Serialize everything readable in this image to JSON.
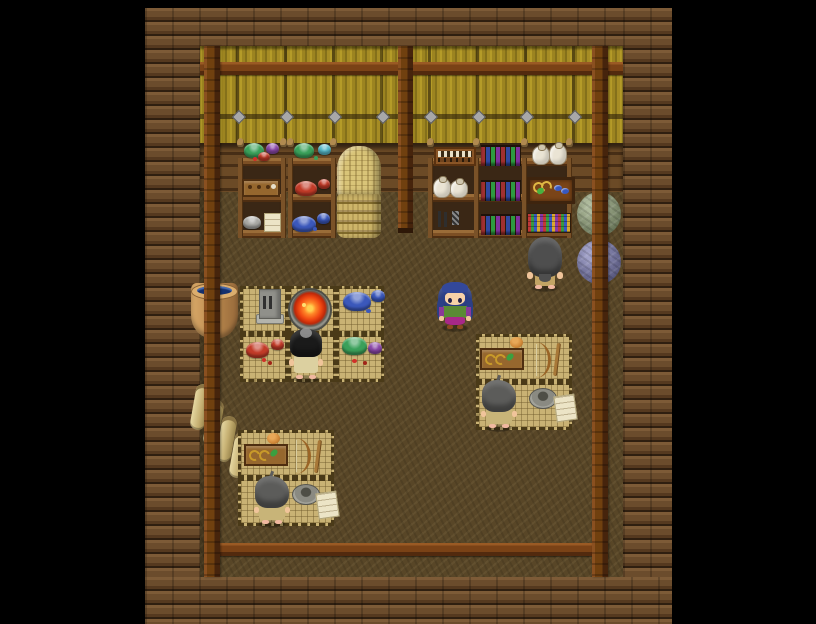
{
  "meta": {
    "type": "game-screenshot",
    "style": "RPG Maker top-down interior, pixel art",
    "scene": "weaving and dye workshop inside a log cabin",
    "resolution": {
      "width": 816,
      "height": 624
    },
    "visible_text": "none"
  },
  "palette": {
    "background": "#000000",
    "log_mid": "#6b4c2c",
    "bamboo_base": "#9c8420",
    "beam": "#7a4216",
    "stud": "#a8a8a8",
    "floor": "#584627",
    "mat": "#c9b274",
    "bowl_green": "#3aa05a",
    "bowl_cyan": "#56b8c8",
    "bowl_red": "#c23b28",
    "bowl_blue": "#3b58bb",
    "bowl_purple": "#8a48a8",
    "bowl_gray": "#a8a8a4",
    "fire_hot": "#ffd050",
    "fire_mid": "#ff8828",
    "fire_deep": "#c02808",
    "yarn_green_hi": "#aeba9c",
    "yarn_green": "#8a9678",
    "yarn_green_lo": "#5e6a4e",
    "yarn_blue_hi": "#a2a2c8",
    "yarn_blue": "#7878a0",
    "yarn_blue_lo": "#4e4e72",
    "dye_liquid": "#14306e",
    "hair_player": "#2c3f86",
    "hair_player_bangs": "#33489a",
    "hair_longgray": "#4e4e4e",
    "hair_black": "#1a1a1a",
    "hair_shaggy": "#5c5c5a",
    "outfit_player_top": "#5a8a34",
    "outfit_player_accent": "#8a3898",
    "outfit_player_skirt": "#a82888",
    "outfit_npc_tan": "#c2a464",
    "outfit_npc_robe": "#dcd0a0",
    "outfit_npc_work": "#c8b478"
  },
  "structure": {
    "walls": "horizontal log border on all four sides",
    "north_wall": "yellow bamboo screen with dark timber frame, horizontal beam and iron studs",
    "pillars": "three dark timber pillars (west, center, east)",
    "floor": "packed earth",
    "south_rail": "timber rail crossing the floor near the south wall"
  },
  "characters": [
    {
      "id": "player",
      "label": "player character",
      "hair": "long blue",
      "facing": "south",
      "outfit": "green top, purple sleeves, magenta skirt"
    },
    {
      "id": "npc_browser",
      "label": "long-haired villager browsing the east shelves",
      "hair": "waist-length dark gray",
      "facing": "north",
      "outfit": "tan"
    },
    {
      "id": "npc_crafter",
      "label": "villager tending the kiln",
      "hair": "black with gray patch",
      "facing": "north",
      "outfit": "pale robe"
    },
    {
      "id": "npc_spinner_east",
      "label": "villager at east work mat",
      "hair": "shaggy gray",
      "facing": "north",
      "outfit": "tan work clothes"
    },
    {
      "id": "npc_spinner_south",
      "label": "villager at south work mat",
      "hair": "shaggy gray",
      "facing": "north",
      "outfit": "tan work clothes"
    }
  ],
  "furniture": {
    "west_shelves": {
      "unit_a": {
        "top": "large green bowl, small violet bowl, small red bowl with red beads",
        "middle": "wooden stamp tray",
        "bottom": "gray bowl and folded paper"
      },
      "unit_b": {
        "top": "large green bowl, small teal bowl",
        "middle": "large and small red dye bowls",
        "bottom": "large and small blue dye bowls"
      }
    },
    "east_shelves": {
      "top_row": [
        "bead abacus",
        "row of colorful books",
        "two cloth sacks"
      ],
      "middle_row": [
        "two cloth sacks",
        "row of colorful books",
        "display case with gold hooks, green thread and blue beads"
      ],
      "bottom_row": [
        "hanging dark tools and woven band",
        "row of colorful books",
        "bolts of patterned cloth"
      ]
    },
    "basket_stack": "tall stack of woven straw baskets beside the west shelves",
    "yarn_balls": [
      "large green yarn ball",
      "large blue-violet yarn ball"
    ],
    "dye_vat": "clay vat full of indigo dye by the west wall",
    "scroll_rolls": "four rolled straw mats cascading along the west wall",
    "workstations": [
      {
        "id": "kiln_station",
        "mats": 6,
        "items": [
          "whetstone slab with chisels",
          "stone kiln with burning fire",
          "blue dye bowls",
          "red dye bowls",
          "green dye bowl with violet bowl"
        ],
        "worker": "npc_crafter"
      },
      {
        "id": "east_station",
        "mats": 2,
        "items": [
          "stamp tray",
          "ball of clay",
          "bow drill",
          "spindle stick",
          "stone mortar",
          "pattern paper"
        ],
        "worker": "npc_spinner_east"
      },
      {
        "id": "south_station",
        "mats": 2,
        "items": [
          "stamp tray",
          "ball of clay",
          "bow drill",
          "spindle stick",
          "stone mortar",
          "pattern paper"
        ],
        "worker": "npc_spinner_south"
      }
    ]
  }
}
